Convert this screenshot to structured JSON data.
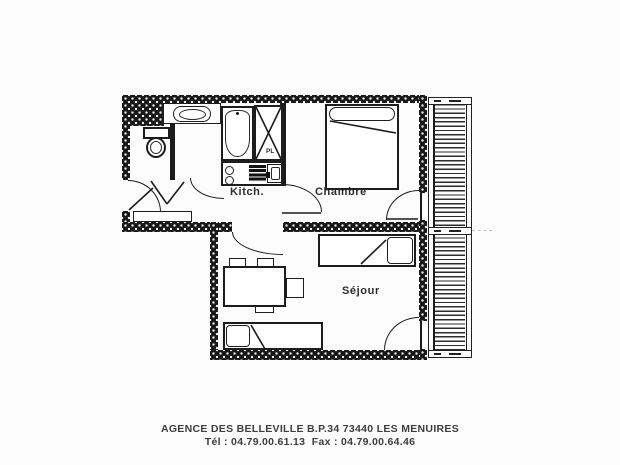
{
  "labels": {
    "kitchen": "Kitch.",
    "bedroom": "Chambre",
    "living_room": "Séjour",
    "closet": "PL"
  },
  "footer": {
    "line1": "AGENCE DES BELLEVILLE B.P.34 73440 LES MENUIRES",
    "line2": "Tél : 04.79.00.61.13  Fax : 04.79.00.64.46"
  },
  "colors": {
    "wall": "#181818",
    "line": "#1c1c1c",
    "label_text": "#2e2e2e",
    "footer_text": "#3e3e3e",
    "background": "#fcfcfc"
  }
}
